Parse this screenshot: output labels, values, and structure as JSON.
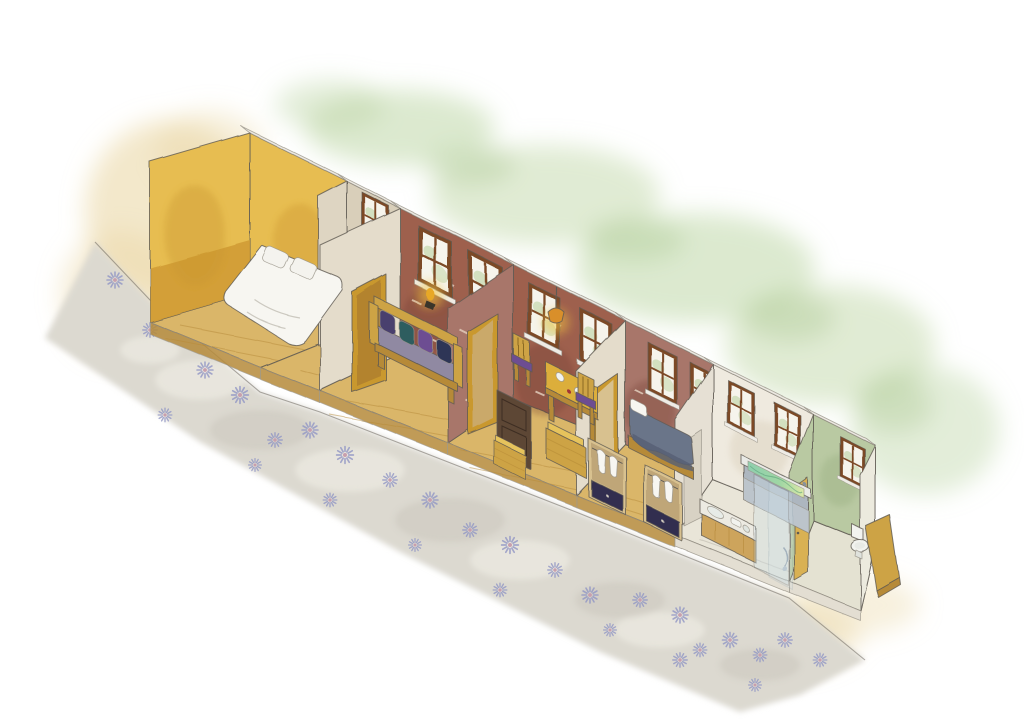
{
  "scene": {
    "title": "Watercolor cutaway illustration of a row-house interior",
    "style": "hand-painted watercolor axonometric cutaway, no text",
    "background": {
      "foliage": "soft green wash behind the roofline",
      "left_wash": "pale ochre watercolor patch at left and lower right",
      "pavement": "grey diagonal band with radiating floral motifs in front of the house"
    },
    "rooms": [
      {
        "name": "Bedroom",
        "wall": "yellow",
        "furniture": [
          "double bed",
          "two pillows"
        ]
      },
      {
        "name": "Entry hall",
        "wall": "beige",
        "furniture": [
          "small window",
          "gold framed door"
        ]
      },
      {
        "name": "Living room",
        "wall": "brick",
        "furniture": [
          "wooden bench with purple cushions",
          "wall sconce",
          "two windows"
        ]
      },
      {
        "name": "Dining room",
        "wall": "brick",
        "furniture": [
          "square table with tableware",
          "two chairs",
          "pendant lamp",
          "dark wooden door",
          "two crates"
        ]
      },
      {
        "name": "Bedroom",
        "wall": "brick",
        "furniture": [
          "bed with slate blue blanket",
          "two wardrobes with hanging clothes",
          "navy drawers"
        ]
      },
      {
        "name": "Bathroom",
        "wall": "cream",
        "furniture": [
          "bathtub with green water",
          "glass shower screen",
          "washstand",
          "shower hose"
        ]
      },
      {
        "name": "WC",
        "wall": "green",
        "furniture": [
          "toilet",
          "wooden counter",
          "yellow door"
        ]
      }
    ]
  },
  "palette": {
    "paper": "#ffffff",
    "ink": "#5f5a52",
    "wash_tan": "#e9d5a0",
    "wash_green": "#bad3a0",
    "wash_green_dark": "#a6c68b",
    "pavement": "#dcd9d0",
    "pavement_light": "#f3f1ea",
    "pavement_dark": "#c5c1b6",
    "flower_petal": "#9196c5",
    "flower_center": "#c79fae",
    "wood_floor": "#dab669",
    "wood_mid": "#cda344",
    "wood_dark": "#b68a39",
    "wood_light": "#e6c35c",
    "wall_yellow": "#e7bd51",
    "wall_yellow_deep": "#cf9a33",
    "wall_beige": "#d9cfba",
    "wall_beige_light": "#ded5c2",
    "partition_cream": "#e4dccb",
    "partition_white": "#e6e0d4",
    "wall_brick": "#9e604e",
    "brick_light": "#a8766a",
    "brick_mortar": "#ecdccb",
    "wall_cream": "#efeadf",
    "wall_green": "#b9c9a2",
    "roof_strip": "#ece9e2",
    "end_sliver": "#eceade",
    "floor_pale": "#e9e5d8",
    "floor_pale2": "#e4e2d2",
    "fascia_pale": "#e3ded2",
    "window_frame": "#7c4a28",
    "window_glass": "#f6f4ec",
    "greenery": "#b7d09c",
    "sill": "#efece6",
    "door_gold": "#c9982f",
    "door_gold_inner": "#b3832f",
    "door_opening": "#caa96b",
    "door_yellow": "#d9b153",
    "door_dark": "#5d4636",
    "lamp_glow": "#f6c53c",
    "lamp_shade": "#d98f2a",
    "bed_white": "#f7f6f1",
    "pillow": "#f4f3ee",
    "seat_gray": "#9089a2",
    "cushion_a": "#4a3f6e",
    "cushion_b": "#2f5d5e",
    "cushion_c": "#6d4e92",
    "cushion_d": "#2e3656",
    "blanket": "#6b7489",
    "blanket_dark": "#565f74",
    "navy_drawer": "#332e50",
    "wardrobe_wood": "#d8c18f",
    "wardrobe_inner": "#bfa678",
    "tub_body": "#adb6bf",
    "tub_panel": "#bcc4cb",
    "tub_rim": "#e9eae6",
    "water_a": "#8fcfae",
    "water_b": "#dce9a8",
    "porcelain": "#f2f3ef",
    "counter_top": "#eceae2",
    "counter_wood": "#cda45c",
    "glass_tint": "#cfe0e8"
  }
}
